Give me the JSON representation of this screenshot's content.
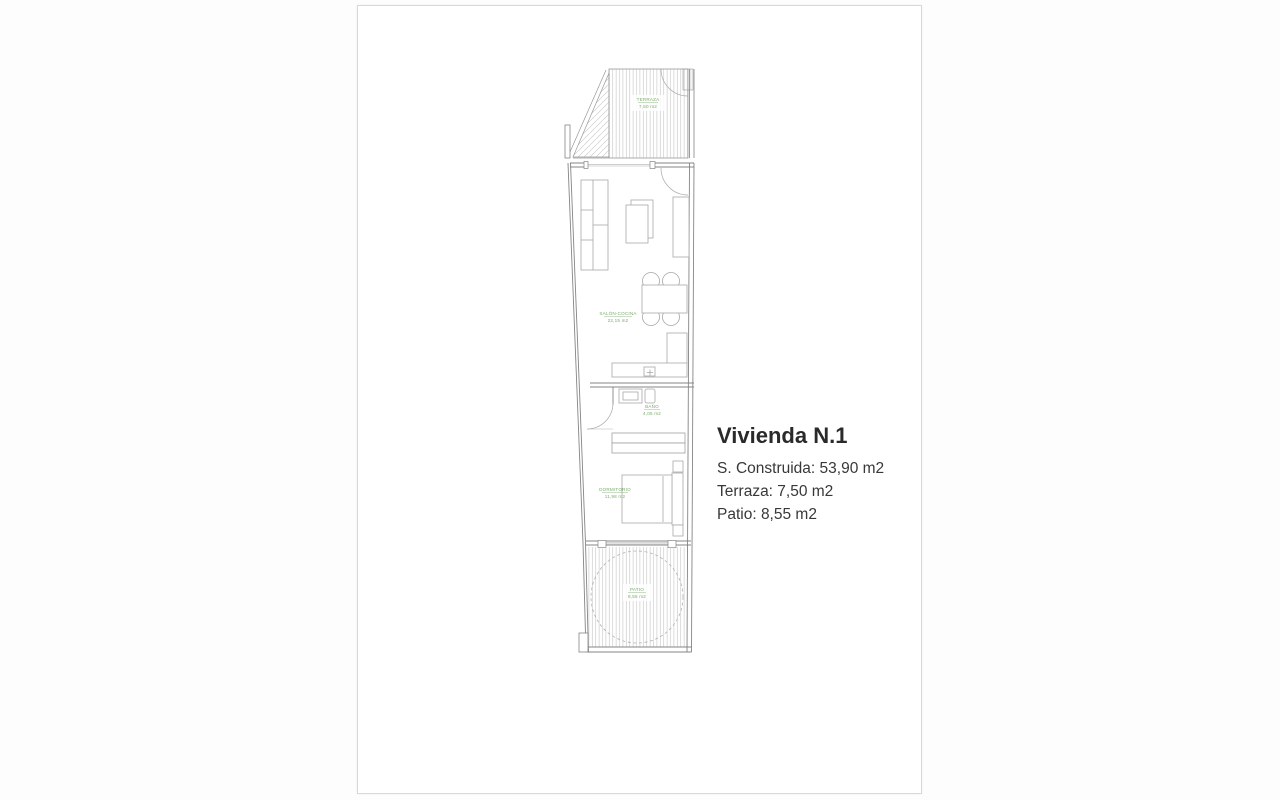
{
  "sheet": {
    "info": {
      "title": "Vivienda N.1",
      "construida": "S. Construida: 53,90 m2",
      "terraza": "Terraza: 7,50 m2",
      "patio": "Patio: 8,55 m2"
    },
    "plan": {
      "rooms": [
        {
          "name": "TERRAZA",
          "area": "7,50 m2"
        },
        {
          "name": "SALÓN-COCINA",
          "area": "22,15 m2"
        },
        {
          "name": "BAÑO",
          "area": "4,05 m2"
        },
        {
          "name": "DORMITORIO",
          "area": "11,98 m2"
        },
        {
          "name": "PATIO",
          "area": "8,55 m2"
        }
      ],
      "label_color": "#7cab6d",
      "wall_color": "#858585",
      "furniture_color": "#a8a8a8",
      "hatch_color": "#c4c4c4"
    }
  }
}
